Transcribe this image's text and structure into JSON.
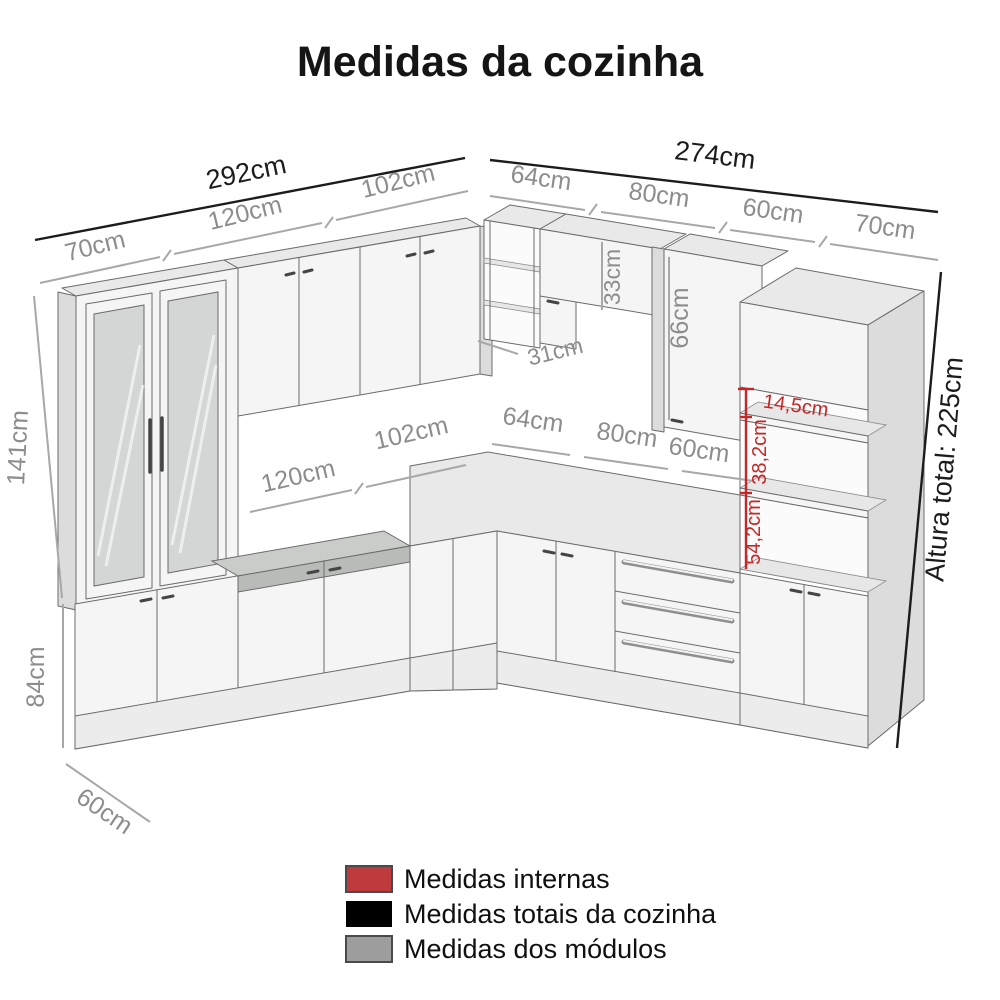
{
  "title": "Medidas da cozinha",
  "diagram": {
    "totals": {
      "left_wall_width": "292cm",
      "right_wall_width": "274cm",
      "total_height": "Altura total: 225cm"
    },
    "modules_top_left": {
      "m70": "70cm",
      "m120": "120cm",
      "m102": "102cm"
    },
    "modules_top_right": {
      "m64": "64cm",
      "m80": "80cm",
      "m60": "60cm",
      "m70": "70cm"
    },
    "counter_left": {
      "m120": "120cm",
      "m102": "102cm"
    },
    "counter_right": {
      "m64": "64cm",
      "m80": "80cm",
      "m60": "60cm"
    },
    "heights": {
      "tall_cabinet": "141cm",
      "base_cabinet": "84cm",
      "wall_cabinet_small": "33cm",
      "wall_cabinet_large": "66cm"
    },
    "depths": {
      "base_depth": "60cm",
      "corner_shelf_depth": "31cm"
    },
    "internal": {
      "niche_top": "14,5cm",
      "niche_middle": "38,2cm",
      "niche_bottom": "54,2cm"
    }
  },
  "legend": {
    "items": [
      {
        "label": "Medidas internas",
        "color": "#bf3a3c"
      },
      {
        "label": "Medidas totais da cozinha",
        "color": "#000000"
      },
      {
        "label": "Medidas dos módulos",
        "color": "#9d9d9d"
      }
    ]
  },
  "colors": {
    "internal": "#c52626",
    "total": "#1c1c1c",
    "module": "#a8a8a8"
  }
}
